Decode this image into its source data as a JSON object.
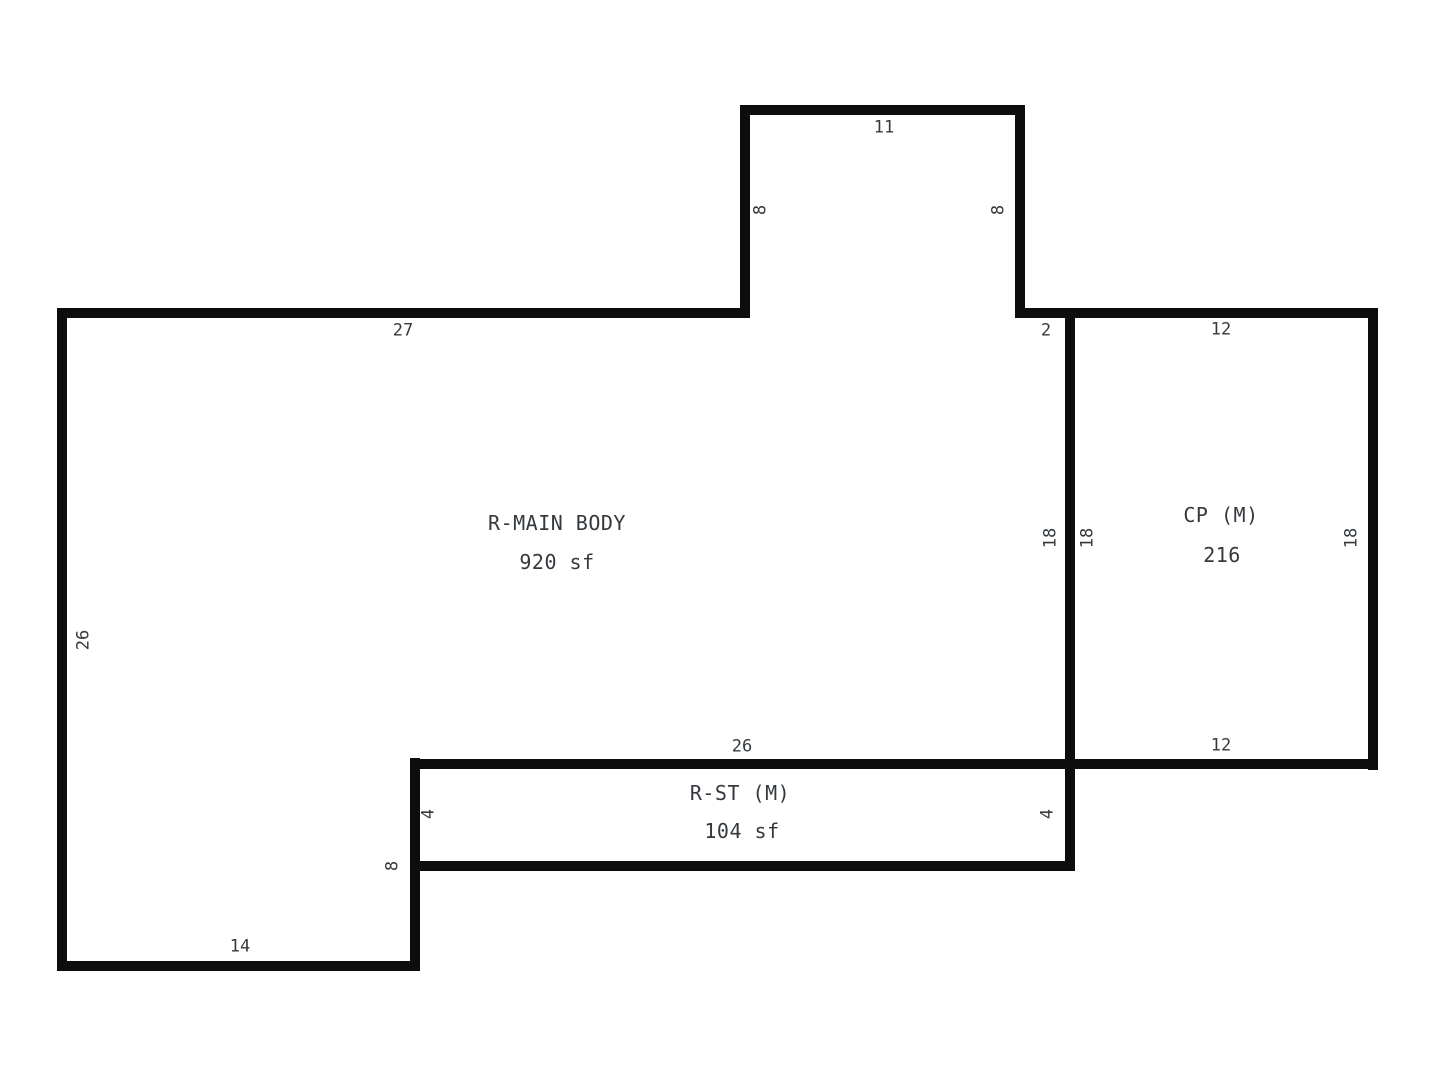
{
  "sketch": {
    "type": "floor-plan-sketch",
    "colors": {
      "background": "#ffffff",
      "wall": "#0d0d0d",
      "text": "#34393e"
    },
    "areas": {
      "main_body": {
        "name": "R-MAIN BODY",
        "size": "920 sf"
      },
      "carport": {
        "name": "CP (M)",
        "size": "216"
      },
      "storage": {
        "name": "R-ST (M)",
        "size": "104 sf"
      }
    },
    "dimensions": {
      "bump_top": "11",
      "bump_left": "8",
      "bump_right": "8",
      "main_top": "27",
      "main_top_offset": "2",
      "carport_top": "12",
      "main_right": "18",
      "carport_left": "18",
      "carport_right": "18",
      "main_left": "26",
      "storage_top": "26",
      "carport_bottom": "12",
      "storage_left": "4",
      "storage_right": "4",
      "storage_outer_wall": "8",
      "leg_bottom": "14"
    }
  }
}
